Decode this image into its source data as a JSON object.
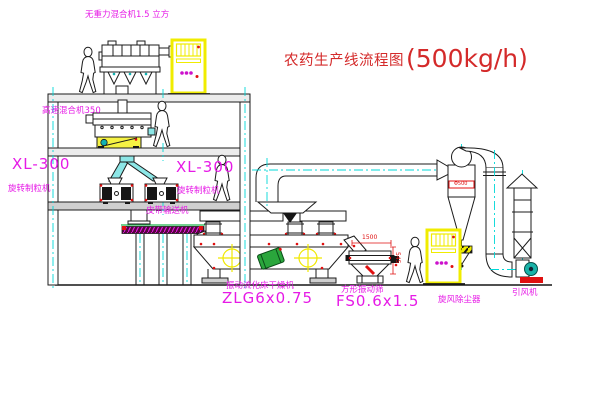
{
  "title": {
    "text": "农药生产线流程图",
    "capacity": "(500kg/h)"
  },
  "labels": {
    "gravity_mixer": "无重力混合机1.5 立方",
    "high_speed_mixer": "高速混合机350",
    "granulator_left_model": "XL-300",
    "granulator_left_name": "旋转制粒机",
    "granulator_right_model": "XL-300",
    "granulator_right_name": "旋转制粒机",
    "belt_conveyor": "皮带输送机",
    "dryer_name": "振动流化床干燥机",
    "dryer_model": "ZLG6x0.75",
    "sieve_name": "方形振动筛",
    "sieve_model": "FS0.6x1.5",
    "cyclone": "旋风除尘器",
    "fan": "引风机"
  },
  "dimensions": {
    "sieve_length": "1500",
    "sieve_height": "545",
    "cyclone_band": "Φ500"
  },
  "colors": {
    "label_magenta": "#e61ae6",
    "title_red": "#d42a2a",
    "dimension_red": "#e01010",
    "centerline_cyan": "#00d8d8",
    "cabinet_yellow": "#f0ec00",
    "chute_cyan": "#8ce6e6",
    "motor_green": "#2aa63c",
    "fan_teal": "#19b2a8"
  }
}
